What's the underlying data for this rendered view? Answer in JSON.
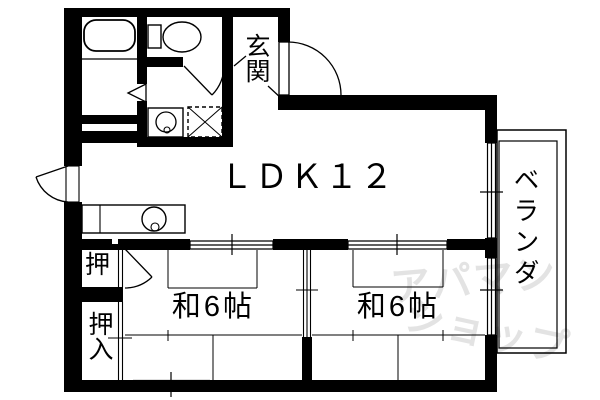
{
  "plan": {
    "title": "apartment floor plan",
    "labels": {
      "entrance": "玄関",
      "ldk": "ＬＤＫ１２",
      "room1": "和6帖",
      "room2": "和6帖",
      "closet_small": "押",
      "closet_large": "押入",
      "veranda": "ベランダ"
    },
    "watermark": {
      "line1": "アパマン",
      "line2": "ショップ"
    },
    "colors": {
      "wall": "#000000",
      "line": "#000000",
      "background": "#ffffff",
      "watermark": "#e3e3e3"
    }
  }
}
